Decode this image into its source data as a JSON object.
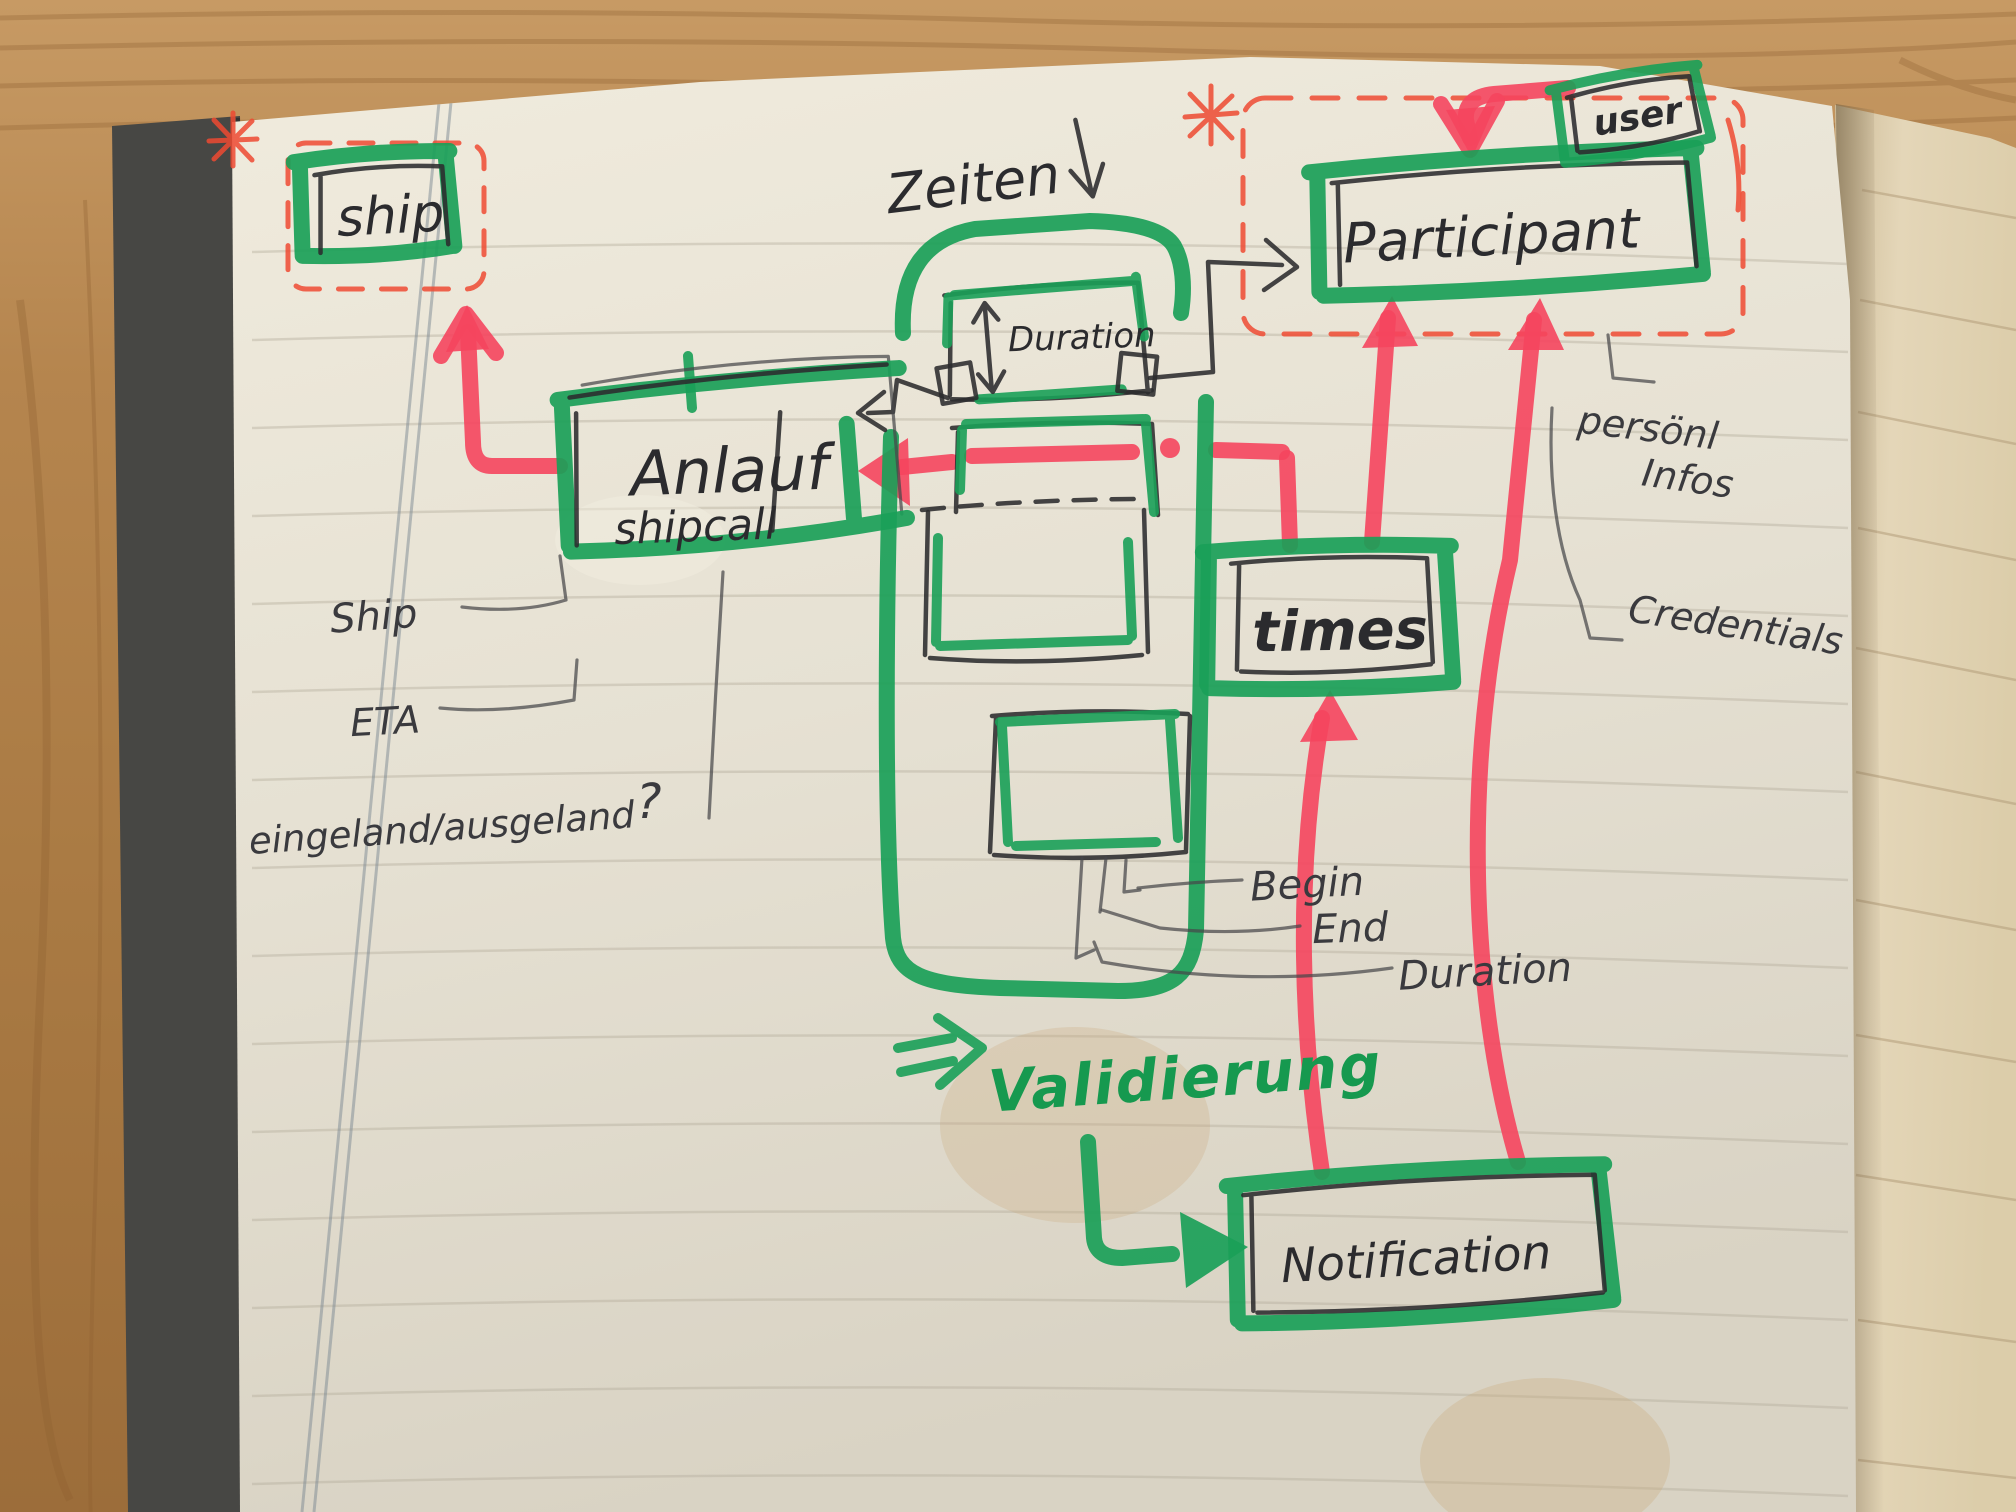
{
  "diagram": {
    "entities": {
      "ship": {
        "label": "ship"
      },
      "anlauf": {
        "title": "Anlauf",
        "subtitle": "shipcall"
      },
      "participant": {
        "label": "Participant"
      },
      "user": {
        "label": "user"
      },
      "times": {
        "label": "times"
      },
      "notification": {
        "label": "Notification"
      },
      "duration_box": {
        "label": "Duration"
      }
    },
    "attributes": {
      "ship_attr": "Ship",
      "eta": "ETA",
      "inout": "eingeland/ausgeland",
      "inout_question": "?",
      "begin": "Begin",
      "end": "End",
      "duration_attr": "Duration",
      "personal_line1": "persönl",
      "personal_line2": "Infos",
      "credentials": "Credentials"
    },
    "annotations": {
      "zeiten": "Zeiten",
      "validierung": "Validierung",
      "asterisk": "*"
    },
    "colors": {
      "marker_green": "#1aa058",
      "marker_red": "#f5455e",
      "pen_red": "#ee4a32",
      "pen_black": "#2b2b2e",
      "paper": "#e8e3d6",
      "wood": "#b5854e"
    }
  }
}
